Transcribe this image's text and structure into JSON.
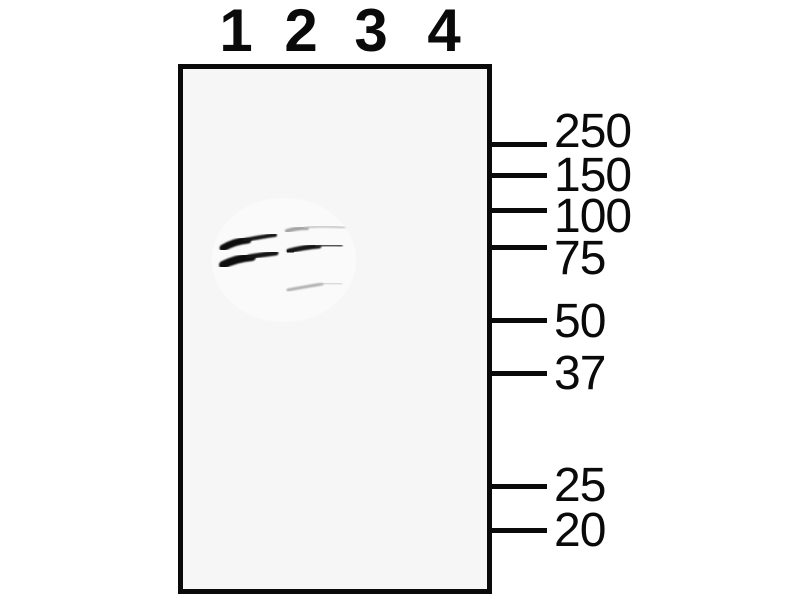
{
  "figure": {
    "kind": "western-blot",
    "colors": {
      "background": "#ffffff",
      "membrane_fill": "#f6f6f6",
      "frame_and_text": "#0a0a0a",
      "band_strong": "#111111",
      "band_medium": "#3c3c3c",
      "band_faint": "#c0c0c0"
    }
  },
  "lanes": [
    {
      "label": "1",
      "x": 235
    },
    {
      "label": "2",
      "x": 300
    },
    {
      "label": "3",
      "x": 370
    },
    {
      "label": "4",
      "x": 443
    }
  ],
  "markers": [
    {
      "label": "250",
      "tick_y": 144,
      "text_y": 132
    },
    {
      "label": "150",
      "tick_y": 175,
      "text_y": 176
    },
    {
      "label": "100",
      "tick_y": 210,
      "text_y": 217
    },
    {
      "label": "75",
      "tick_y": 247,
      "text_y": 259
    },
    {
      "label": "50",
      "tick_y": 320,
      "text_y": 322
    },
    {
      "label": "37",
      "tick_y": 373,
      "text_y": 374
    },
    {
      "label": "25",
      "tick_y": 486,
      "text_y": 486
    },
    {
      "label": "20",
      "tick_y": 530,
      "text_y": 531
    }
  ],
  "wash_patch": {
    "cx": 284,
    "cy": 260,
    "rx": 72,
    "ry": 62,
    "color": "#ffffff",
    "opacity": 0.55
  },
  "bands": [
    {
      "name": "lane1-upper-band-left",
      "d": "M 223 248 C 230 244 238 241 248 240",
      "width": 7,
      "color": "#0d0d0d",
      "opacity": 1
    },
    {
      "name": "lane1-upper-band-right",
      "d": "M 245 240 C 256 238 266 236 275 235",
      "width": 4,
      "color": "#181818",
      "opacity": 1
    },
    {
      "name": "lane1-lower-band-left",
      "d": "M 223 265 C 231 261 241 258 252 257",
      "width": 8,
      "color": "#0b0b0b",
      "opacity": 1
    },
    {
      "name": "lane1-lower-band-right",
      "d": "M 249 257 C 259 255 268 254 276 253",
      "width": 5,
      "color": "#141414",
      "opacity": 1
    },
    {
      "name": "lane2-upper-faint-band-left",
      "d": "M 287 231 C 293 229 300 228 307 228",
      "width": 4,
      "color": "#8e8e8e",
      "opacity": 0.8
    },
    {
      "name": "lane2-upper-faint-band-right",
      "d": "M 305 228 C 317 226 330 226 344 228",
      "width": 3,
      "color": "#c2c2c2",
      "opacity": 0.75
    },
    {
      "name": "lane2-main-band-dot",
      "d": "M 288 252 L 293 250",
      "width": 6,
      "color": "#000000",
      "opacity": 1
    },
    {
      "name": "lane2-main-band-left",
      "d": "M 289 251 C 297 249 307 247 319 246",
      "width": 5,
      "color": "#151515",
      "opacity": 1
    },
    {
      "name": "lane2-main-band-right",
      "d": "M 317 246 C 327 245 335 245 341 246",
      "width": 3.5,
      "color": "#3c3c3c",
      "opacity": 0.9
    },
    {
      "name": "lane2-lower-faint-band-left",
      "d": "M 288 290 C 298 288 310 286 322 284",
      "width": 3,
      "color": "#9a9a9a",
      "opacity": 0.75
    },
    {
      "name": "lane2-lower-faint-band-right",
      "d": "M 320 284 C 328 283 335 283 341 284",
      "width": 2.5,
      "color": "#c6c6c6",
      "opacity": 0.7
    }
  ]
}
